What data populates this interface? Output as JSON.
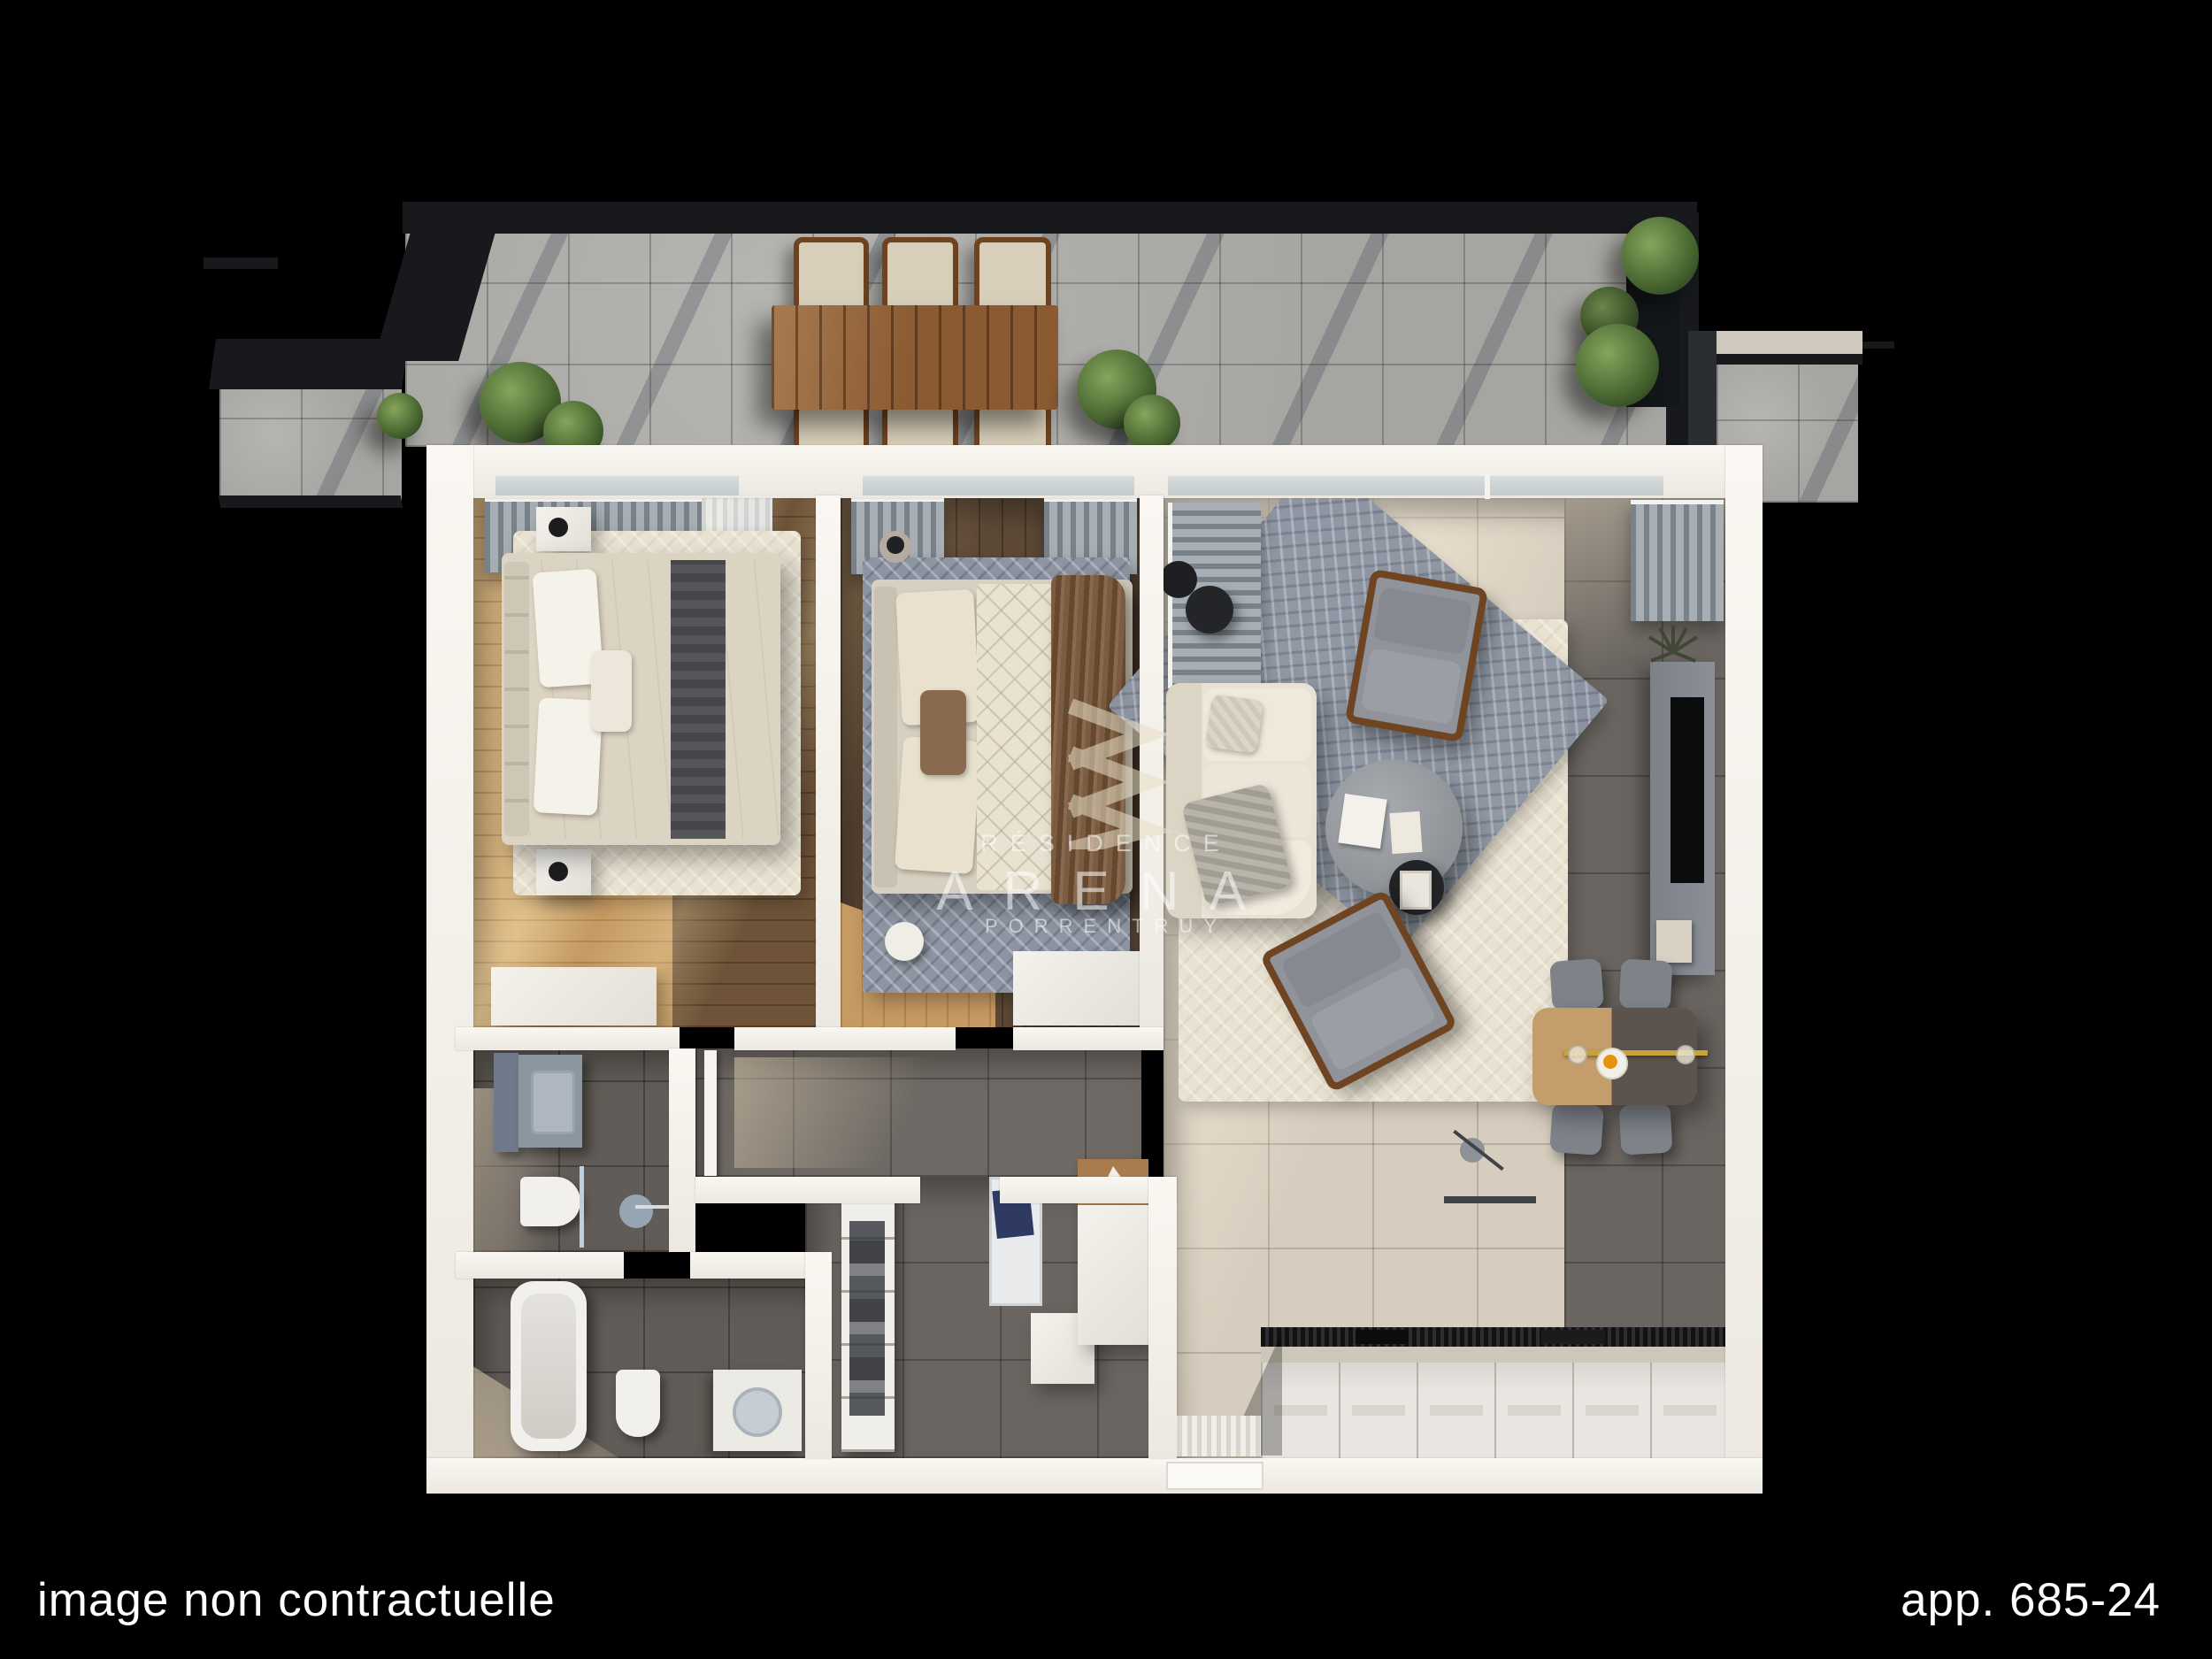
{
  "footer": {
    "left_caption": "image non contractuelle",
    "right_caption": "app. 685-24"
  },
  "watermark": {
    "label": "RÉSIDENCE",
    "brand": "ARENA",
    "city": "PORRENTRUY",
    "logo": "triple-chevron-right"
  },
  "palette": {
    "background": "#000000",
    "caption_text": "#ffffff",
    "wall_white": "#f2efe9",
    "terrace_tile_gray": "#a6a5a1",
    "pergola_frame": "#17191d",
    "wood_floor_light_oak": "#c59a63",
    "wood_floor_walnut": "#5d4936",
    "living_tile_beige": "#d7cdbe",
    "dark_tile_gray": "#6a6560",
    "rug_cream": "#e9e2d1",
    "rug_blue_gray": "#8d95a3",
    "sofa_cream": "#e8e2d4",
    "dining_table_light": "#c49e6a",
    "dining_table_dark": "#5c544c",
    "pendant_gold": "#c9a23a",
    "greenery": "#4c6a33",
    "terrace_table_wood": "#8a5a33"
  }
}
